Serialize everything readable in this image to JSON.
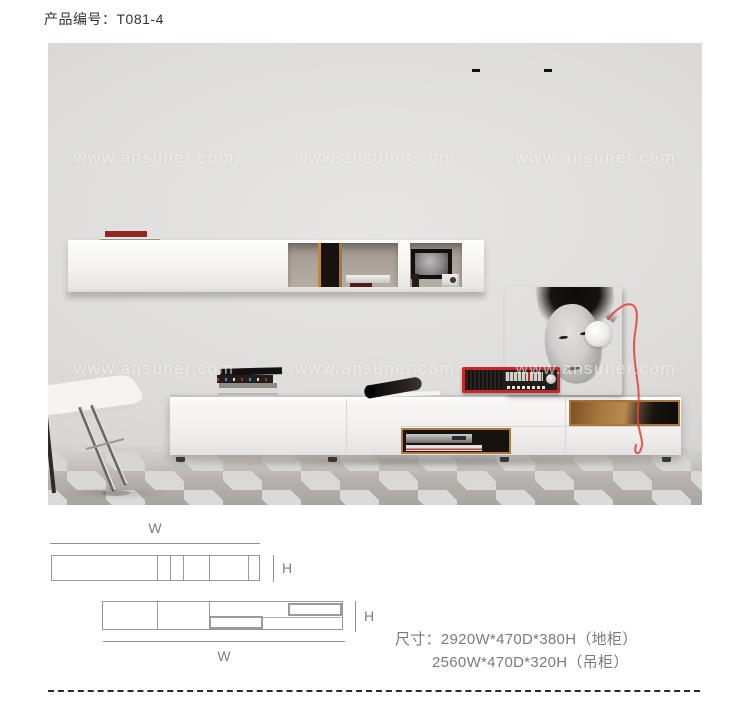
{
  "header": {
    "product_label": "产品编号：T081-4"
  },
  "photo": {
    "watermark": "www.ansuner.com"
  },
  "diagrams": {
    "wall_cabinet": {
      "width_label": "W",
      "height_label": "H"
    },
    "floor_cabinet": {
      "width_label": "W",
      "height_label": "H"
    }
  },
  "dimensions": {
    "line1": "尺寸：2920W*470D*380H（地柜）",
    "line2": "2560W*470D*320H（吊柜）"
  },
  "colors": {
    "accent_red": "#c6272b",
    "cord_red": "#e2453c",
    "wood": "#ad7a3d",
    "text_gray": "#7b7b7b",
    "diagram_line": "#979797"
  }
}
